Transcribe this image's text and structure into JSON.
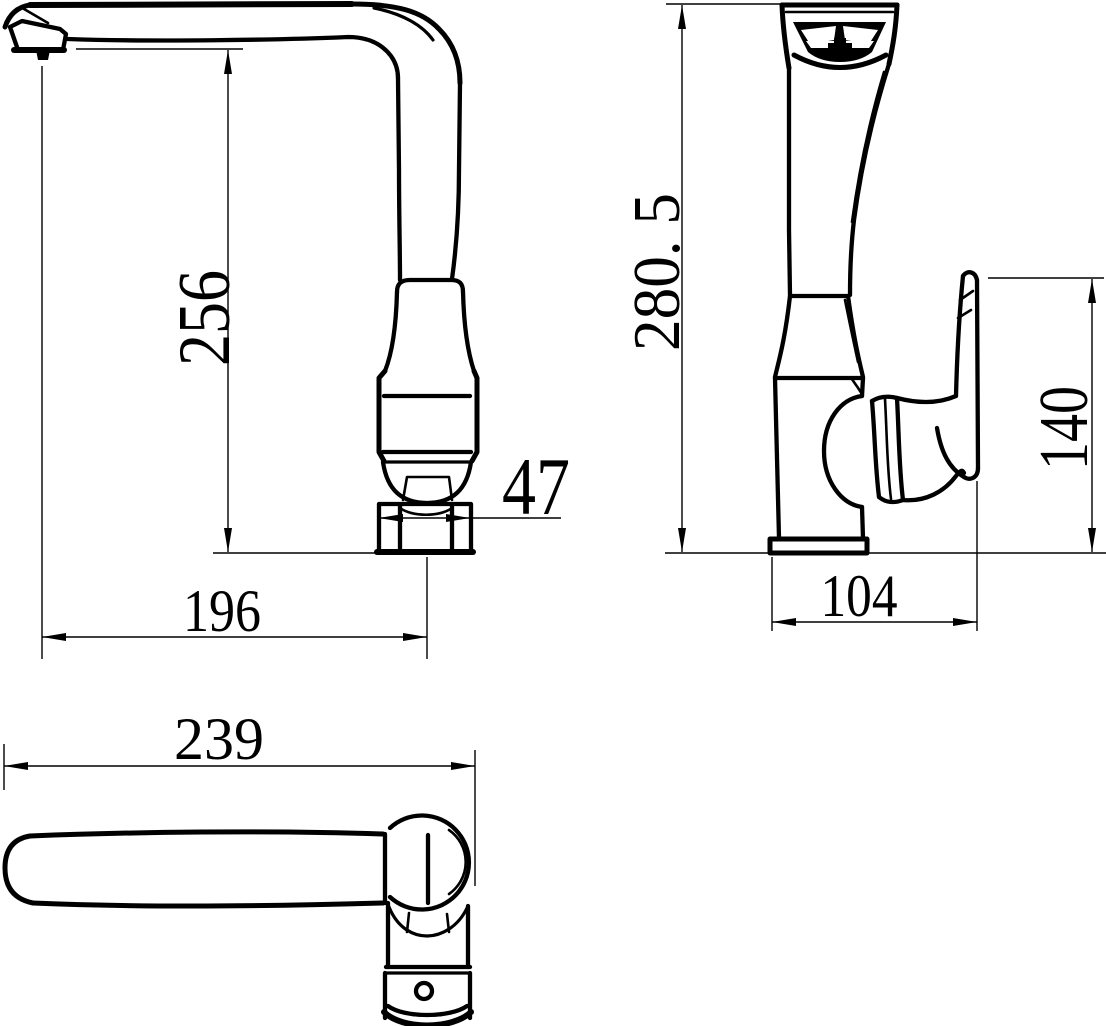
{
  "page": {
    "background": "#ffffff",
    "ink": "#000000"
  },
  "dims": {
    "d256": "256",
    "d47": "47",
    "d196": "196",
    "d280_5": "280. 5",
    "d140": "140",
    "d104": "104",
    "d239": "239"
  }
}
